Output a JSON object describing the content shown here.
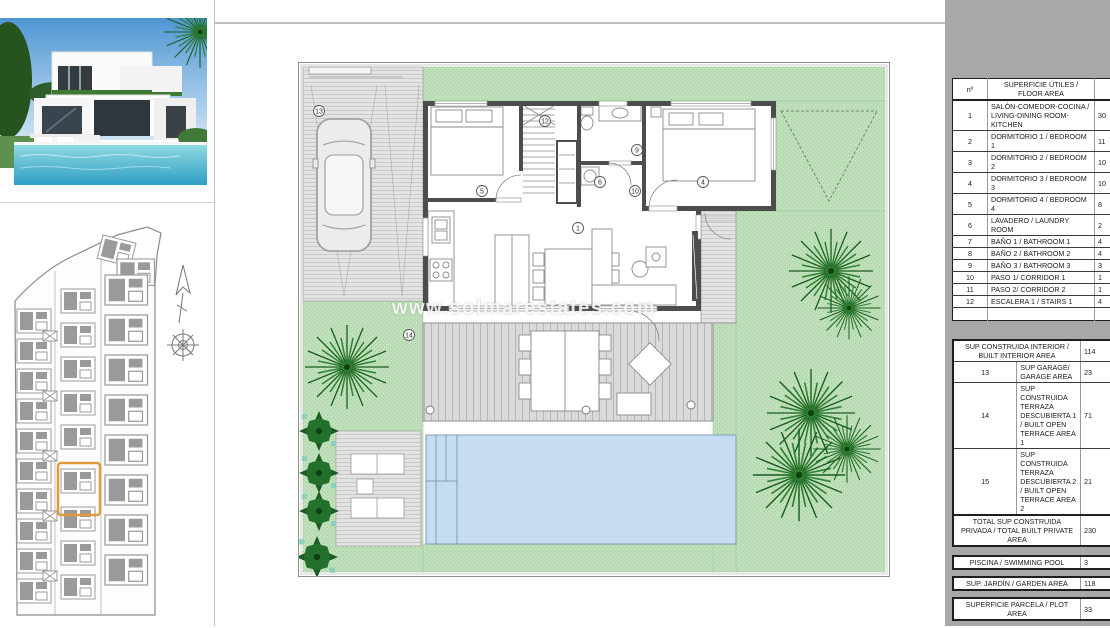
{
  "watermark": "www.solmarestates.com",
  "colors": {
    "accent_orange": "#e09a3c",
    "garden_green": "#b5dcb0",
    "pool_blue": "#c6dcf1",
    "panel_gray": "#a8a8a8"
  },
  "plan": {
    "labels": [
      {
        "text": "13"
      },
      {
        "text": "12"
      },
      {
        "text": "5"
      },
      {
        "text": "9"
      },
      {
        "text": "6"
      },
      {
        "text": "10"
      },
      {
        "text": "4"
      },
      {
        "text": "1"
      },
      {
        "text": "14"
      }
    ]
  },
  "panel": {
    "floor_table": {
      "headers": {
        "num": "nº",
        "area": "SUPERFICIE ÚTILES / FLOOR AREA",
        "tip": "TIP"
      },
      "rows": [
        {
          "n": "1",
          "label": "SALÓN-COMEDOR-COCINA / LIVING-DINING ROOM-KITCHEN",
          "value": "30"
        },
        {
          "n": "2",
          "label": "DORMITORIO 1 / BEDROOM 1",
          "value": "11"
        },
        {
          "n": "3",
          "label": "DORMITORIO 2 / BEDROOM 2",
          "value": "10"
        },
        {
          "n": "4",
          "label": "DORMITORIO 3 / BEDROOM 3",
          "value": "10"
        },
        {
          "n": "5",
          "label": "DORMITORIO 4 / BEDROOM 4",
          "value": "8"
        },
        {
          "n": "6",
          "label": "LAVADERO / LAUNDRY ROOM",
          "value": "2"
        },
        {
          "n": "7",
          "label": "BAÑO 1 / BATHROOM 1",
          "value": "4"
        },
        {
          "n": "8",
          "label": "BAÑO 2 / BATHROOM 2",
          "value": "4"
        },
        {
          "n": "9",
          "label": "BAÑO 3 / BATHROOM 3",
          "value": "3"
        },
        {
          "n": "10",
          "label": "PASO 1/ CORRIDOR 1",
          "value": "1"
        },
        {
          "n": "11",
          "label": "PASO 2/ CORRIDOR 2",
          "value": "1"
        },
        {
          "n": "12",
          "label": "ESCALERA 1 / STAIRS 1",
          "value": "4"
        }
      ]
    },
    "built_table": {
      "rows": [
        {
          "n": "",
          "label": "SUP CONSTRUIDA INTERIOR / BUILT INTERIOR AREA",
          "value": "114"
        },
        {
          "n": "13",
          "label": "SUP GARAGE/ GARAGE AREA",
          "value": "23"
        },
        {
          "n": "14",
          "label": "SUP CONSTRUIDA TERRAZA DESCUBIERTA 1 / BUILT OPEN TERRACE AREA 1",
          "value": "71"
        },
        {
          "n": "15",
          "label": "SUP CONSTRUIDA TERRAZA DESCUBIERTA 2 / BUILT OPEN TERRACE AREA 2",
          "value": "21"
        },
        {
          "n": "",
          "label": "TOTAL SUP CONSTRUIDA PRIVADA / TOTAL BUILT PRIVATE AREA",
          "value": "230"
        }
      ]
    },
    "pool_row": {
      "label": "PISCINA / SWIMMING POOL",
      "value": "3"
    },
    "garden_row": {
      "label": "SUP. JARDÍN / GARDEN AREA",
      "value": "118"
    },
    "plot_row": {
      "label": "SUPERFICIE PARCELA / PLOT AREA",
      "value": "33"
    }
  }
}
